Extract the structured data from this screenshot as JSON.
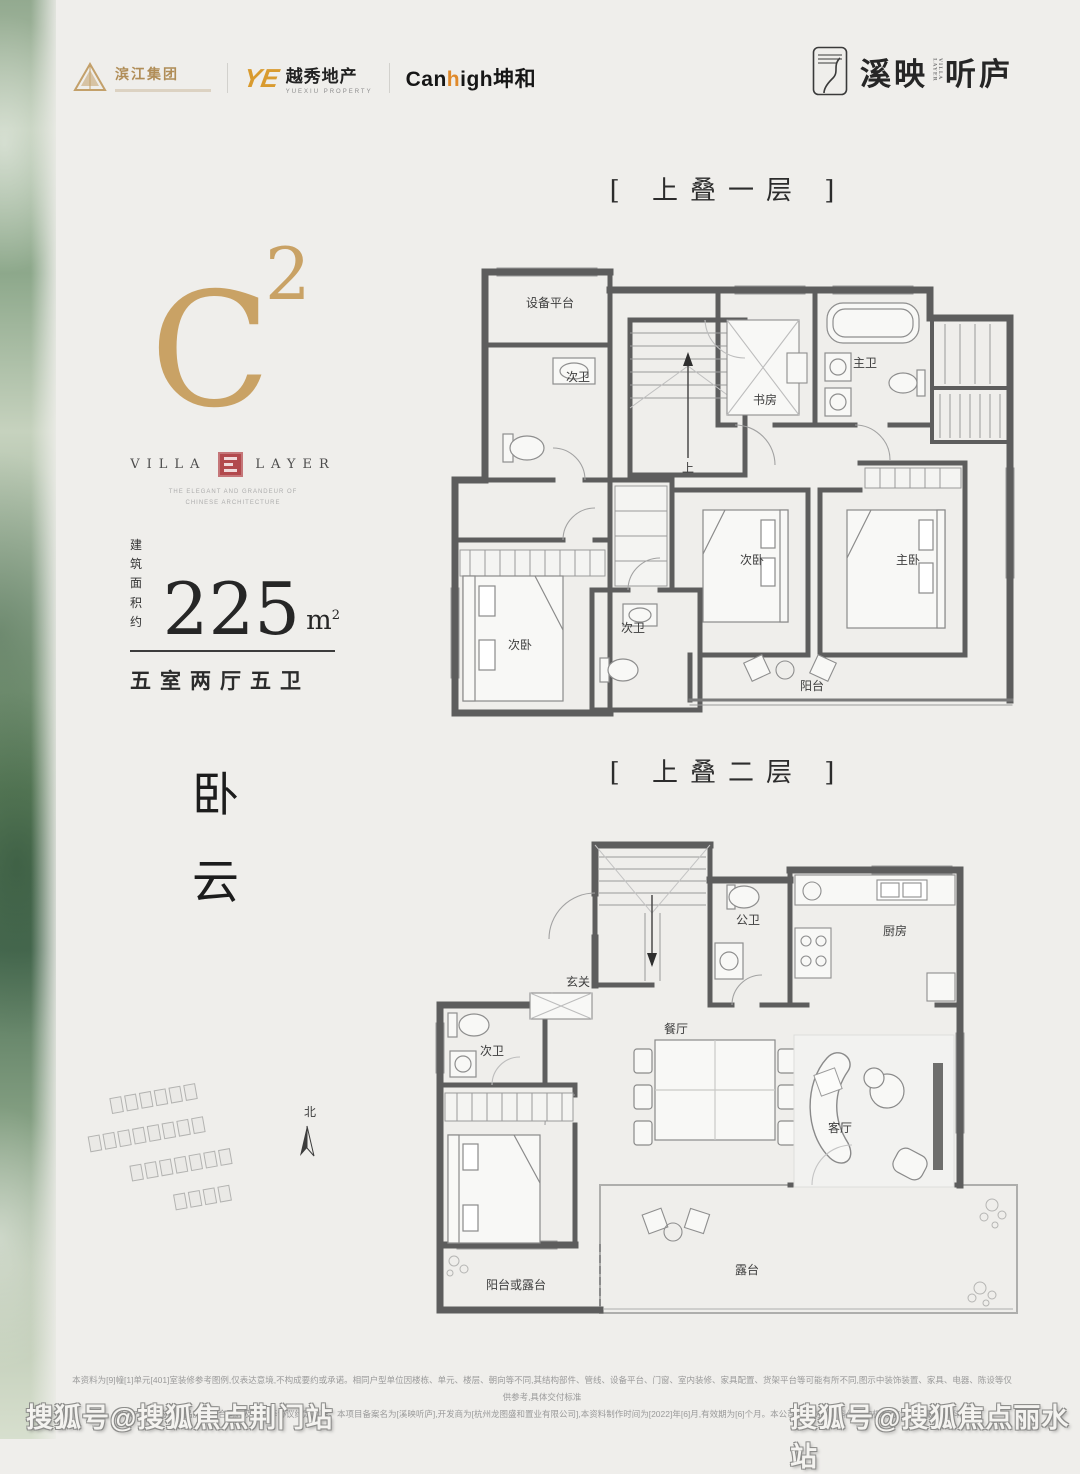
{
  "colors": {
    "accent_gold": "#c9a265",
    "seal_red": "#b2494d",
    "wall_gray": "#5d5d5d",
    "strip_green": "#628560"
  },
  "header": {
    "dev_logos": {
      "binjiang": "滨江集团",
      "yuexiu": "越秀地产",
      "yuexiu_sub": "YUEXIU PROPERTY",
      "canhigh_pre": "Can",
      "canhigh_gold": "h",
      "canhigh_post": "igh",
      "canhigh_cn": "坤和"
    },
    "brand": {
      "title_left": "溪映",
      "title_right": "听庐",
      "mini": "VILLA LAYER"
    }
  },
  "left_panel": {
    "unit_code": "C",
    "unit_sup": "2",
    "series_left": "VILLA",
    "series_right": "LAYER",
    "series_sub1": "THE ELEGANT AND GRANDEUR OF",
    "series_sub2": "CHINESE ARCHITECTURE",
    "area_prefix_line1": "建 筑",
    "area_prefix_line2": "面积约",
    "area_value": "225",
    "area_unit": "m",
    "area_unit_sup": "2",
    "rooms_line": "五室两厅五卫",
    "poem_char_1": "卧",
    "poem_char_2": "云",
    "north_label": "北"
  },
  "floor1": {
    "title": "[ 上叠一层 ]",
    "stair_up": "上",
    "rooms": {
      "equipment_platform": "设备平台",
      "bath_a": "次卫",
      "study": "书房",
      "master_bath": "主卫",
      "bedroom_a": "次卧",
      "bath_b": "次卫",
      "bedroom_b": "次卧",
      "master_bedroom": "主卧",
      "balcony": "阳台"
    }
  },
  "floor2": {
    "title": "[ 上叠二层 ]",
    "rooms": {
      "foyer": "玄关",
      "public_bath": "公卫",
      "kitchen": "厨房",
      "dining": "餐厅",
      "bath": "次卫",
      "bedroom": "次卧",
      "living": "客厅",
      "balcony_or_terrace": "阳台或露台",
      "terrace": "露台"
    }
  },
  "footer": {
    "line1": "本资料为[9]幢[1]单元[401]室装修参考图例,仅表达意境,不构成要约或承诺。相同户型单位因楼栋、单元、楼层、朝向等不同,其结构部件、管线、设备平台、门窗、室内装修、家具配置、货架平台等可能有所不同,图示中装饰装置、家具、电器、陈设等仅供参考,具体交付标准",
    "line2": "以双方签订的《商品房买卖合同》及附件等协议约定为准。本项目备案名为[溪映听庐],开发商为[杭州龙图盛和置业有限公司],本资料制作时间为[2022]年[6]月,有效期为[6]个月。本公司保留对本资料修改的权利,敬请留意最新资料。"
  },
  "watermarks": {
    "left": "搜狐号@搜狐焦点荆门站",
    "right": "搜狐号@搜狐焦点丽水站"
  }
}
